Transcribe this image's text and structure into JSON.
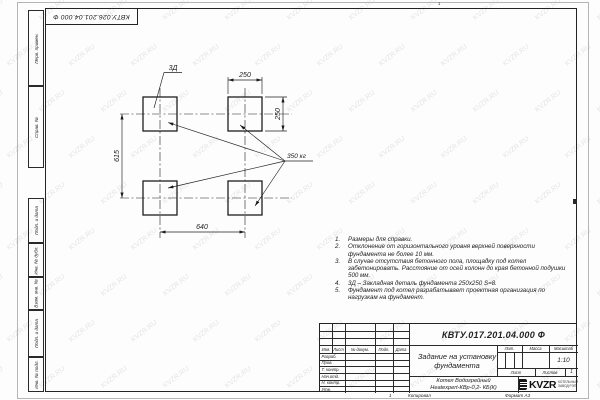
{
  "watermark": {
    "text": "KVZR.RU"
  },
  "sheet": {
    "top_reference": "КВТУ.026.201.04.000 Ф",
    "zone_top": "1",
    "zone_bottom": "1",
    "margin_stamps_top": [
      "Перв. примен.",
      "Справ. №"
    ],
    "margin_stamps_bottom": [
      "Подп. и дата",
      "Инв. № дубл.",
      "Взам. инв. №",
      "Подп. и дата",
      "Инв. № подл."
    ],
    "footer": {
      "copied": "Копировал",
      "format": "Формат А3"
    }
  },
  "drawing": {
    "dim_top_width": "250",
    "dim_right_height": "250",
    "dim_left_spacing": "615",
    "dim_bottom_spacing": "640",
    "embed_label": "3Д",
    "load_label": "350 кг"
  },
  "notes": [
    {
      "num": "1.",
      "text": "Размеры для справки."
    },
    {
      "num": "2.",
      "text": "Отклонение от горизонтального уровня верхней поверхности фундамента не более 10 мм."
    },
    {
      "num": "3.",
      "text": "В случае отсутствия бетонного пола, площадку под котел забетонировать. Расстояние от осей колонн до края бетонной подушки 500 мм."
    },
    {
      "num": "4.",
      "text": "3Д – Закладная деталь фундамента 250х250 S=8."
    },
    {
      "num": "5.",
      "text": "Фундамент под котел разрабатывает проектная организация по нагрузкам на фундамент."
    }
  ],
  "title_block": {
    "designation": "КВТУ.017.201.04.000 Ф",
    "doc_title": "Задание на установку фундамента",
    "product_line1": "Котел Водогрейный",
    "product_line2": "Heatexpert-КВр-0,2- КБ(К)",
    "scale": "1:10",
    "sheets_total": "1",
    "headers": {
      "izm": "Изм.",
      "list": "Лист",
      "docnum": "№ докум.",
      "podp": "Подп.",
      "date": "Дата",
      "lit": "Лит.",
      "mass": "Масса",
      "scale": "Масштаб",
      "sheet": "Лист",
      "sheets": "Листов"
    },
    "signature_rows": [
      "Разраб.",
      "Пров.",
      "Т. контр.",
      "Нач.отд.",
      "Н. контр.",
      "Утв."
    ],
    "logo": {
      "brand": "KVZR",
      "line1": "КОТЕЛЬНЫЙ",
      "line2": "ЗАВОД РЭП"
    }
  }
}
